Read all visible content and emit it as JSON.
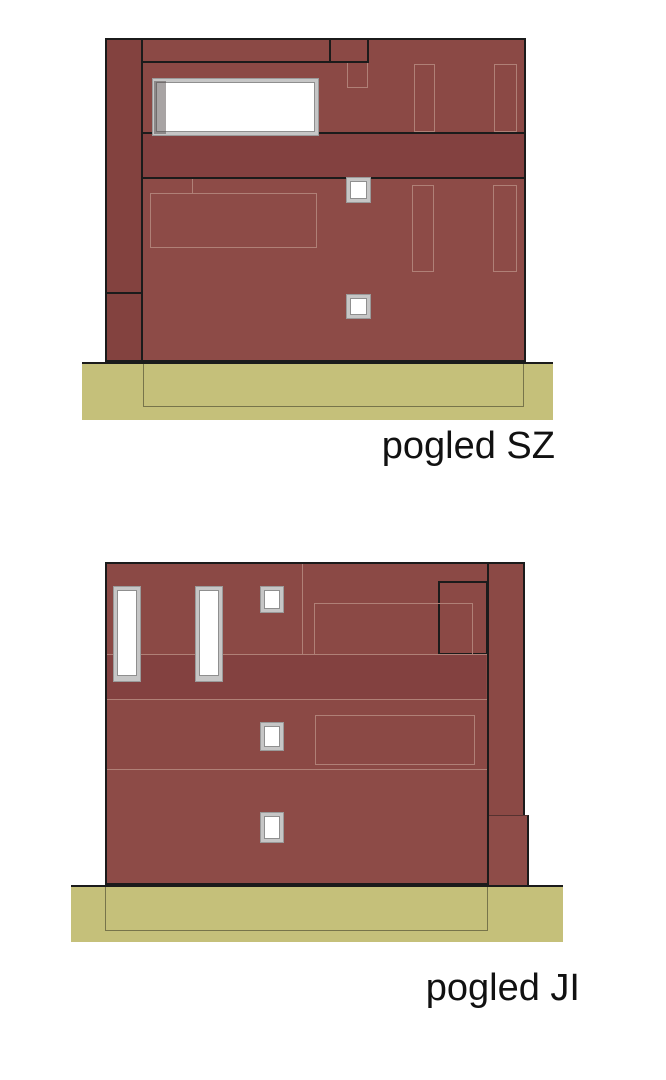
{
  "sheet": {
    "background": "#FFFFFF",
    "kind": "architectural elevation drawings"
  },
  "elevations": [
    {
      "id": "sz",
      "label": "pogled SZ"
    },
    {
      "id": "ji",
      "label": "pogled JI"
    }
  ],
  "colors": {
    "facade": "#8B4945",
    "facade_dark_band": "#834140",
    "facade_strip": "#83423F",
    "facade_light": "#8D4B47",
    "facade_step": "#8E4C48",
    "joint_line": "#B08077",
    "outline": "#1B1B1B",
    "ground": "#C5C07A",
    "foundation_line": "#77744A",
    "window_frame": "#C6C6C6",
    "window_frame_inner": "#8F8F8F",
    "window_glass": "#FFFFFF",
    "label_text": "#111111"
  }
}
